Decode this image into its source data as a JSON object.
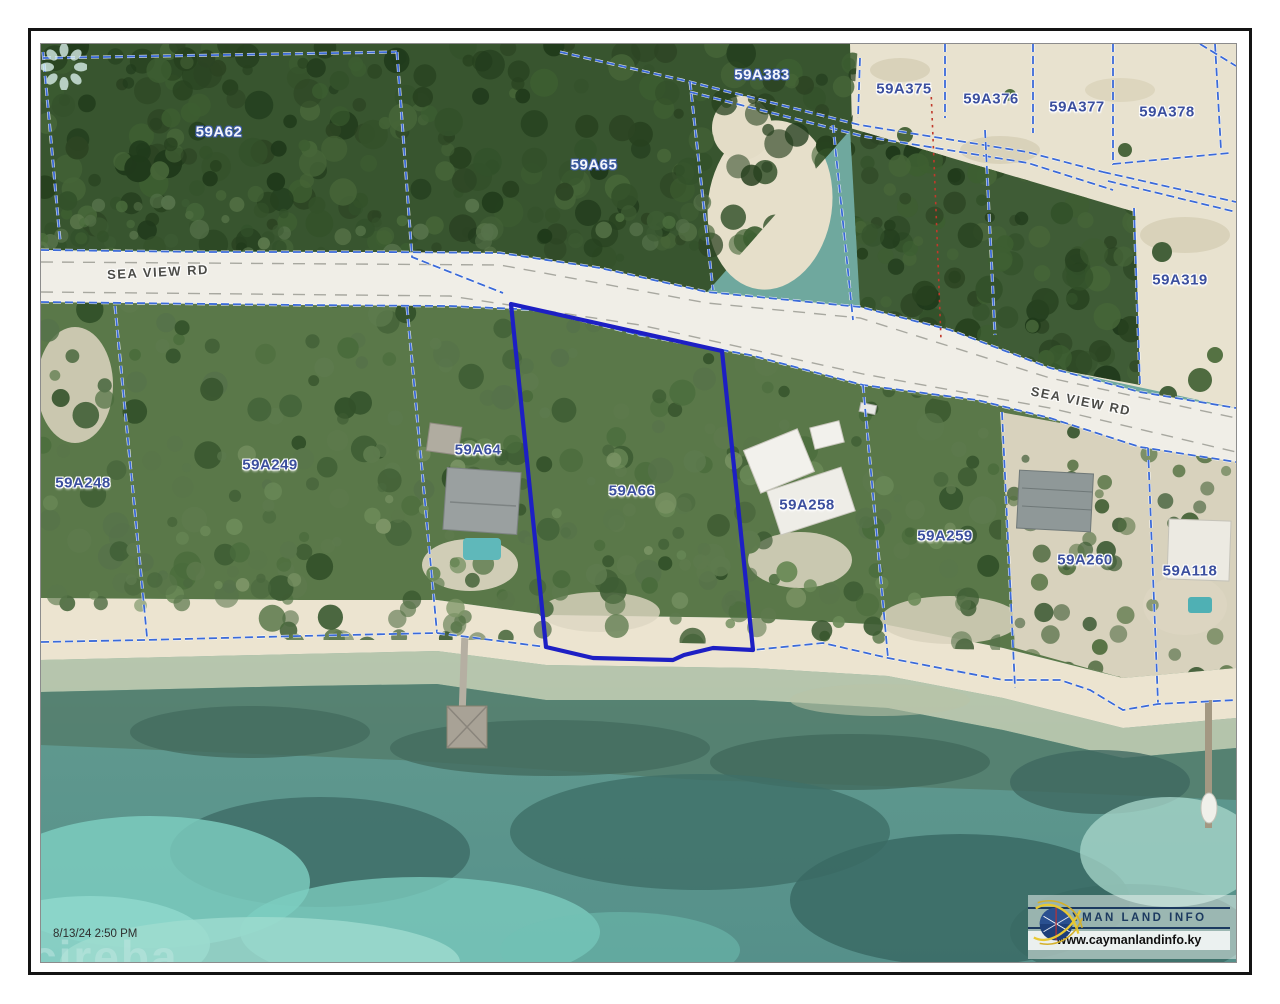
{
  "map": {
    "road_label_left": "SEA VIEW RD",
    "road_label_right": "SEA VIEW RD",
    "highlighted_parcel": "59A66",
    "parcels": [
      {
        "id": "59A62",
        "style": "light"
      },
      {
        "id": "59A65",
        "style": "light"
      },
      {
        "id": "59A383",
        "style": "light"
      },
      {
        "id": "59A375",
        "style": "dark"
      },
      {
        "id": "59A376",
        "style": "dark"
      },
      {
        "id": "59A377",
        "style": "dark"
      },
      {
        "id": "59A378",
        "style": "dark"
      },
      {
        "id": "59A319",
        "style": "dark"
      },
      {
        "id": "59A248",
        "style": "dark"
      },
      {
        "id": "59A249",
        "style": "dark"
      },
      {
        "id": "59A64",
        "style": "dark"
      },
      {
        "id": "59A66",
        "style": "dark"
      },
      {
        "id": "59A258",
        "style": "dark"
      },
      {
        "id": "59A259",
        "style": "dark"
      },
      {
        "id": "59A260",
        "style": "dark"
      },
      {
        "id": "59A118",
        "style": "dark"
      }
    ],
    "colors": {
      "parcel_line": "#3b6ad8",
      "highlight_line": "#1d1fc4",
      "survey_dotted_line": "#c0392b",
      "label_dark": "#3b4f9e",
      "label_light": "#f4f6fa"
    }
  },
  "watermark": {
    "timestamp": "8/13/24 2:50 PM",
    "brand": "cireba"
  },
  "logo": {
    "name": "CAYMAN LAND INFO",
    "url": "www.caymanlandinfo.ky"
  }
}
